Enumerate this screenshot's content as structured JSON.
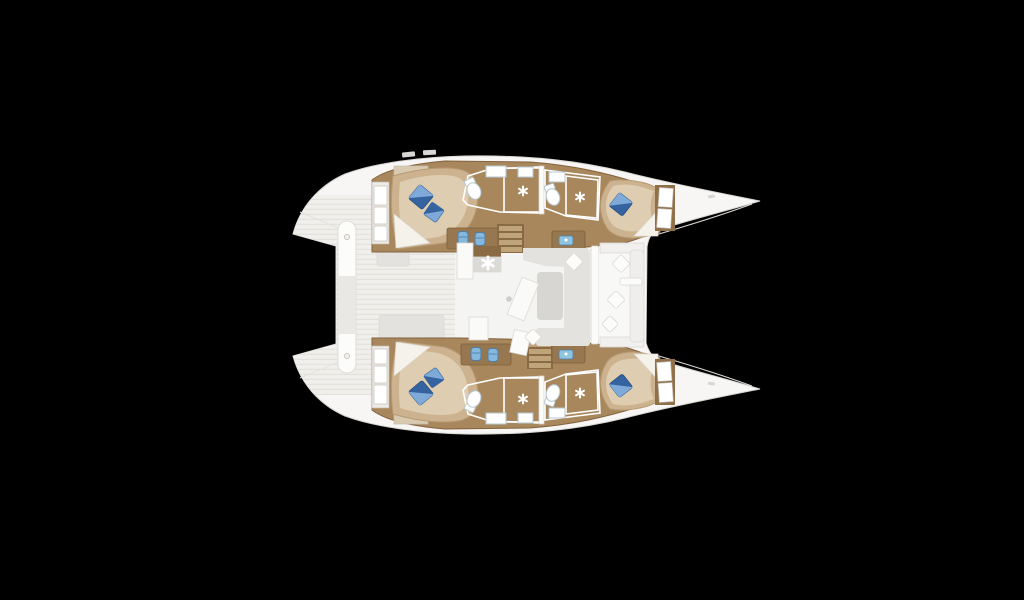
{
  "meta": {
    "description": "Top-down interior floor plan of a four-cabin sailing catamaran rendered on a black background, bows pointing right",
    "image_type": "yacht-floor-plan"
  },
  "colors": {
    "background": "#000000",
    "hull": "#f7f6f5",
    "deck": "#f0efeb",
    "salon_floor": "#f4f4f2",
    "cockpit_floor": "#f8f8f6",
    "wood": "#a8875d",
    "wood_dark": "#8a6a44",
    "wood_furniture": "#96774f",
    "step_tread": "#bfa379",
    "bed_frame": "#ccb28e",
    "bed_mattress": "#decdb0",
    "sheet": "#f5f2ec",
    "pillow_dark": "#35639f",
    "pillow_light": "#7fa9d8",
    "bath_floor": "#c8e6f0",
    "shower": "#92cde1",
    "fixture_white": "#ffffff",
    "seat_blue": "#85b8dc",
    "sink_blue": "#8fc4e0",
    "sofa_gray": "#e3e2df",
    "table_gray": "#d7d6d3",
    "cushion_white": "#fcfcfb",
    "platform_white": "#fcfcfb",
    "platform_mid": "#eae8e4"
  },
  "boat": {
    "orientation": "bows-right",
    "hull_count": 2,
    "cabins": [
      {
        "id": "port-aft-cabin",
        "bed": "double",
        "pillows": 2
      },
      {
        "id": "port-forward-cabin",
        "bed": "double",
        "pillows": 1
      },
      {
        "id": "starboard-aft-cabin",
        "bed": "double",
        "pillows": 2
      },
      {
        "id": "starboard-forward-cabin",
        "bed": "double",
        "pillows": 1
      }
    ],
    "bathrooms": [
      {
        "id": "port-aft-head",
        "fixtures": [
          "toilet",
          "sink",
          "shower"
        ]
      },
      {
        "id": "port-forward-head",
        "fixtures": [
          "toilet",
          "sink",
          "shower"
        ]
      },
      {
        "id": "starboard-aft-head",
        "fixtures": [
          "toilet",
          "sink",
          "shower"
        ]
      },
      {
        "id": "starboard-forward-head",
        "fixtures": [
          "toilet",
          "sink",
          "shower"
        ]
      }
    ],
    "common_areas": [
      "salon",
      "galley",
      "forward-cockpit",
      "aft-deck"
    ],
    "icons": [
      "ceiling-fan-icon",
      "shower-fan-icon",
      "toilet-icon",
      "sink-icon",
      "seat-icon",
      "pillow-icon"
    ]
  }
}
